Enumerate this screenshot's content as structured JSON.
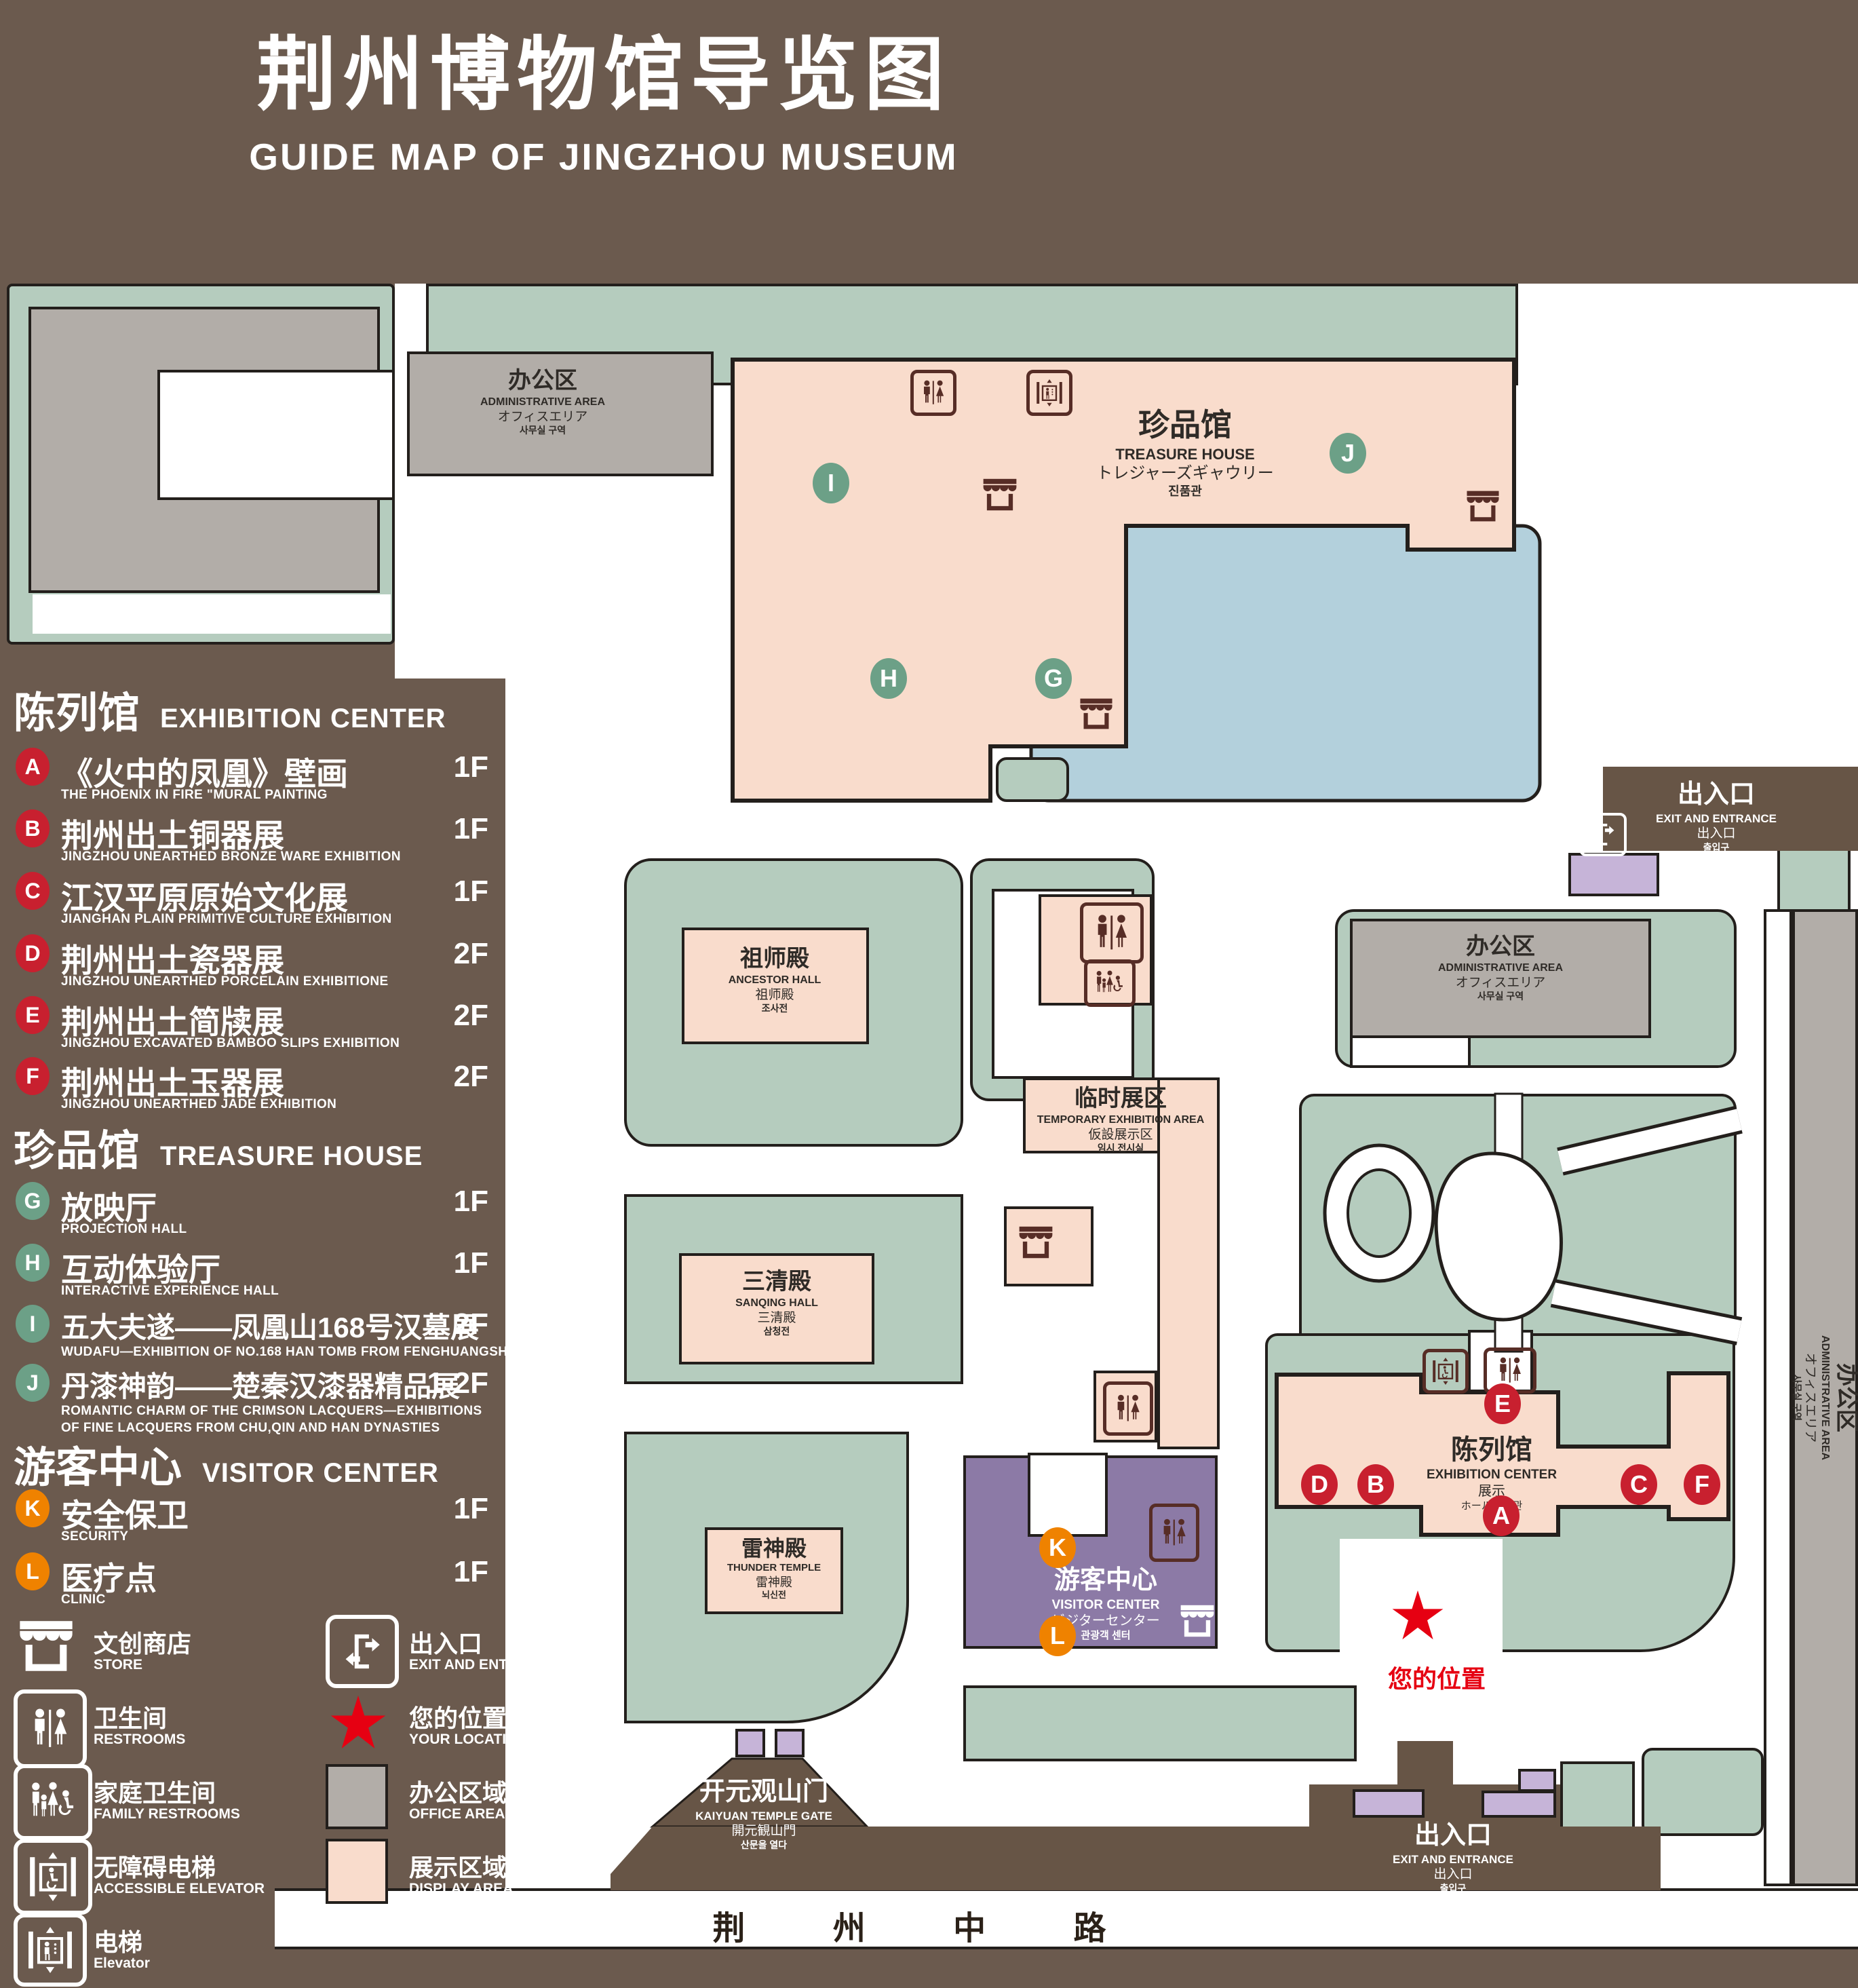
{
  "title": {
    "zh": "荆州博物馆导览图",
    "en": "GUIDE MAP OF JINGZHOU MUSEUM"
  },
  "colors": {
    "background": "#6b5a4e",
    "display_area": "#f9dccc",
    "office_area": "#b2ada8",
    "green_space": "#b5ccbe",
    "pond": "#b3d0dc",
    "visitor_center": "#8c7aa6",
    "entrance_block": "#c6b4d8",
    "marker_red": "#c8202f",
    "marker_green": "#6ca087",
    "marker_orange": "#ef8200",
    "location_red": "#e60012",
    "icon_brown": "#572d26"
  },
  "legend": {
    "sections": [
      {
        "zh": "陈列馆",
        "en": "EXHIBITION CENTER",
        "items": [
          {
            "id": "A",
            "zh": "《火中的凤凰》壁画",
            "en": "THE PHOENIX IN FIRE \"MURAL PAINTING",
            "floor": "1F"
          },
          {
            "id": "B",
            "zh": "荆州出土铜器展",
            "en": "JINGZHOU UNEARTHED BRONZE WARE EXHIBITION",
            "floor": "1F"
          },
          {
            "id": "C",
            "zh": "江汉平原原始文化展",
            "en": "JIANGHAN PLAIN PRIMITIVE CULTURE EXHIBITION",
            "floor": "1F"
          },
          {
            "id": "D",
            "zh": "荆州出土瓷器展",
            "en": "JINGZHOU UNEARTHED PORCELAIN EXHIBITIONE",
            "floor": "2F"
          },
          {
            "id": "E",
            "zh": "荆州出土简牍展",
            "en": "JINGZHOU EXCAVATED BAMBOO SLIPS EXHIBITION",
            "floor": "2F"
          },
          {
            "id": "F",
            "zh": "荆州出土玉器展",
            "en": "JINGZHOU UNEARTHED JADE EXHIBITION",
            "floor": "2F"
          }
        ]
      },
      {
        "zh": "珍品馆",
        "en": "TREASURE HOUSE",
        "items": [
          {
            "id": "G",
            "zh": "放映厅",
            "en": "PROJECTION HALL",
            "floor": "1F"
          },
          {
            "id": "H",
            "zh": "互动体验厅",
            "en": "INTERACTIVE EXPERIENCE HALL",
            "floor": "1F"
          },
          {
            "id": "I",
            "zh": "五大夫遂——凤凰山168号汉墓展",
            "en": "WUDAFU—EXHIBITION OF NO.168 HAN TOMB FROM FENGHUANGSHAN",
            "floor": "2F"
          },
          {
            "id": "J",
            "zh": "丹漆神韵——楚秦汉漆器精品展",
            "en": "ROMANTIC CHARM OF THE CRIMSON LACQUERS—EXHIBITIONS",
            "en2": "OF FINE LACQUERS FROM CHU,QIN AND HAN DYNASTIES",
            "floor": "1-2F"
          }
        ]
      },
      {
        "zh": "游客中心",
        "en": "VISITOR CENTER",
        "items": [
          {
            "id": "K",
            "zh": "安全保卫",
            "en": "SECURITY",
            "floor": "1F"
          },
          {
            "id": "L",
            "zh": "医疗点",
            "en": "CLINIC",
            "floor": "1F"
          }
        ]
      }
    ],
    "symbols": [
      {
        "icon": "store-icon",
        "zh": "文创商店",
        "en": "STORE"
      },
      {
        "icon": "exit-icon",
        "zh": "出入口",
        "en": "EXIT AND ENTRANCE"
      },
      {
        "icon": "restroom-icon",
        "zh": "卫生间",
        "en": "RESTROOMS"
      },
      {
        "icon": "location-star-icon",
        "zh": "您的位置",
        "en": "YOUR LOCATION"
      },
      {
        "icon": "family-restroom-icon",
        "zh": "家庭卫生间",
        "en": "FAMILY RESTROOMS"
      },
      {
        "icon": "office-swatch",
        "zh": "办公区域",
        "en": "OFFICE AREA"
      },
      {
        "icon": "accessible-elevator-icon",
        "zh": "无障碍电梯",
        "en": "ACCESSIBLE ELEVATOR"
      },
      {
        "icon": "display-swatch",
        "zh": "展示区域",
        "en": "DISPLAY AREA"
      },
      {
        "icon": "elevator-icon",
        "zh": "电梯",
        "en": "Elevator"
      }
    ]
  },
  "map": {
    "admin_nw": {
      "zh": "办公区",
      "en": "ADMINISTRATIVE AREA",
      "jp": "オフィスエリア",
      "kr": "사무실 구역"
    },
    "treasure_house": {
      "zh": "珍品馆",
      "en": "TREASURE HOUSE",
      "jp": "トレジャーズギャウリー",
      "kr": "진품관"
    },
    "exit_right": {
      "zh": "出入口",
      "en": "EXIT AND ENTRANCE",
      "jp": "出入口",
      "kr": "출입구"
    },
    "ancestor_hall": {
      "zh": "祖师殿",
      "en": "ANCESTOR HALL",
      "jp": "祖师殿",
      "kr": "조사전"
    },
    "admin_mid": {
      "zh": "办公区",
      "en": "ADMINISTRATIVE AREA",
      "jp": "オフィスエリア",
      "kr": "사무실 구역"
    },
    "temporary_area": {
      "zh": "临时展区",
      "en": "TEMPORARY EXHIBITION AREA",
      "jp": "仮設展示区",
      "kr": "임시 전시실"
    },
    "sanqing_hall": {
      "zh": "三清殿",
      "en": "SANQING HALL",
      "jp": "三清殿",
      "kr": "삼청전"
    },
    "thunder_temple": {
      "zh": "雷神殿",
      "en": "THUNDER TEMPLE",
      "jp": "雷神殿",
      "kr": "뇌신전"
    },
    "visitor_center": {
      "zh": "游客中心",
      "en": "VISITOR CENTER",
      "jp": "ビジターセンター",
      "kr": "관광객 센터"
    },
    "exhibition_center": {
      "zh": "陈列馆",
      "en": "EXHIBITION CENTER",
      "jp": "展示",
      "jp2": "ホール 진열관"
    },
    "admin_right": {
      "zh": "办公区",
      "en": "ADMINISTRATIVE AREA",
      "jp": "オフィスエリア",
      "kr": "사무실 구역"
    },
    "gate": {
      "zh": "开元观山门",
      "en": "KAIYUAN TEMPLE GATE",
      "jp": "開元観山門",
      "kr": "산문을 열다"
    },
    "exit_bottom": {
      "zh": "出入口",
      "en": "EXIT AND ENTRANCE",
      "jp": "出入口",
      "kr": "출입구"
    },
    "road": "荆 州 中 路",
    "your_location": "您的位置",
    "markers": {
      "A": "A",
      "B": "B",
      "C": "C",
      "D": "D",
      "E": "E",
      "F": "F",
      "G": "G",
      "H": "H",
      "I": "I",
      "J": "J",
      "K": "K",
      "L": "L"
    }
  }
}
